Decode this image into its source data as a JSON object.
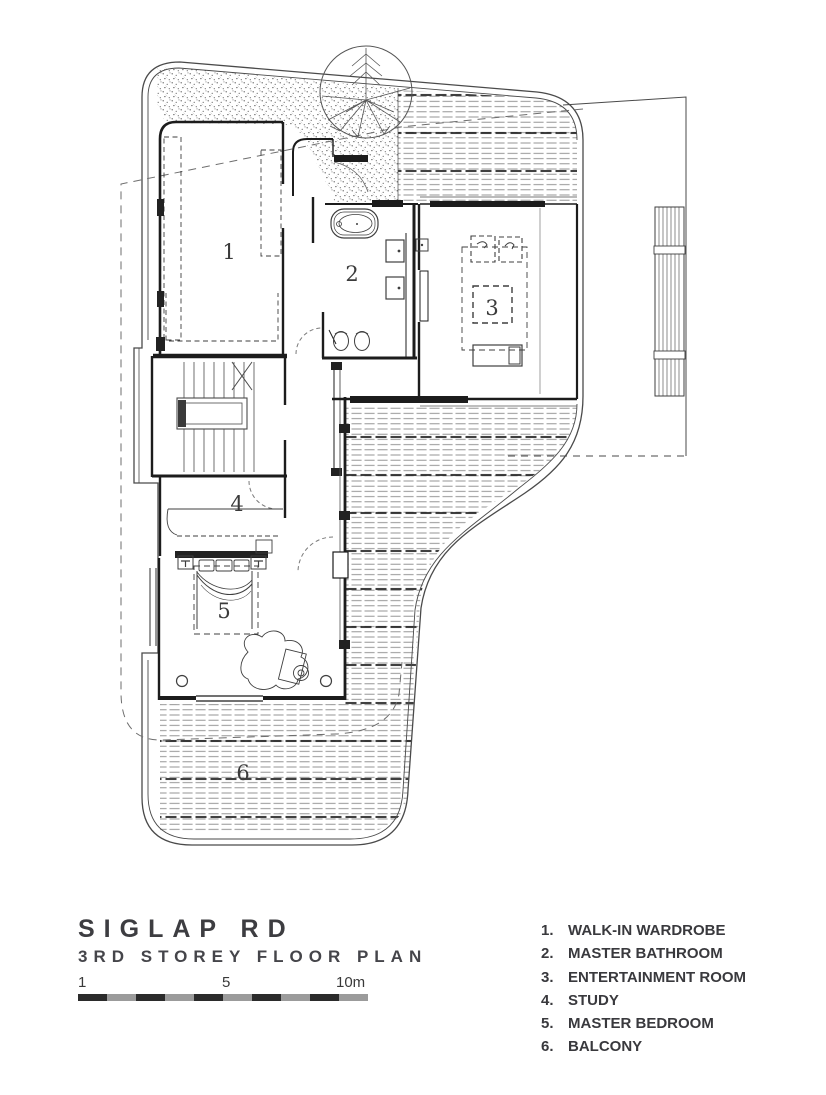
{
  "title_block": {
    "title": "SIGLAP RD",
    "subtitle": "3RD STOREY FLOOR PLAN",
    "scale": {
      "start_label": "1",
      "mid_label": "5",
      "end_label": "10m"
    }
  },
  "legend": {
    "items": [
      {
        "num": "1.",
        "label": "WALK-IN WARDROBE"
      },
      {
        "num": "2.",
        "label": "MASTER BATHROOM"
      },
      {
        "num": "3.",
        "label": "ENTERTAINMENT ROOM"
      },
      {
        "num": "4.",
        "label": "STUDY"
      },
      {
        "num": "5.",
        "label": "MASTER BEDROOM"
      },
      {
        "num": "6.",
        "label": "BALCONY"
      }
    ]
  },
  "rooms": [
    {
      "n": "1",
      "name": "walk-in wardrobe"
    },
    {
      "n": "2",
      "name": "master bathroom"
    },
    {
      "n": "3",
      "name": "entertainment room"
    },
    {
      "n": "4",
      "name": "study"
    },
    {
      "n": "5",
      "name": "master bedroom"
    },
    {
      "n": "6",
      "name": "balcony"
    }
  ],
  "colors": {
    "wall_line": "#1c1c1c",
    "boundary_line": "#4a4a4a",
    "hatch_gray": "#8a8a8a",
    "scale_dark": "#2b2b2b",
    "scale_gray": "#9b9b9b",
    "text": "#3a3a3a"
  }
}
